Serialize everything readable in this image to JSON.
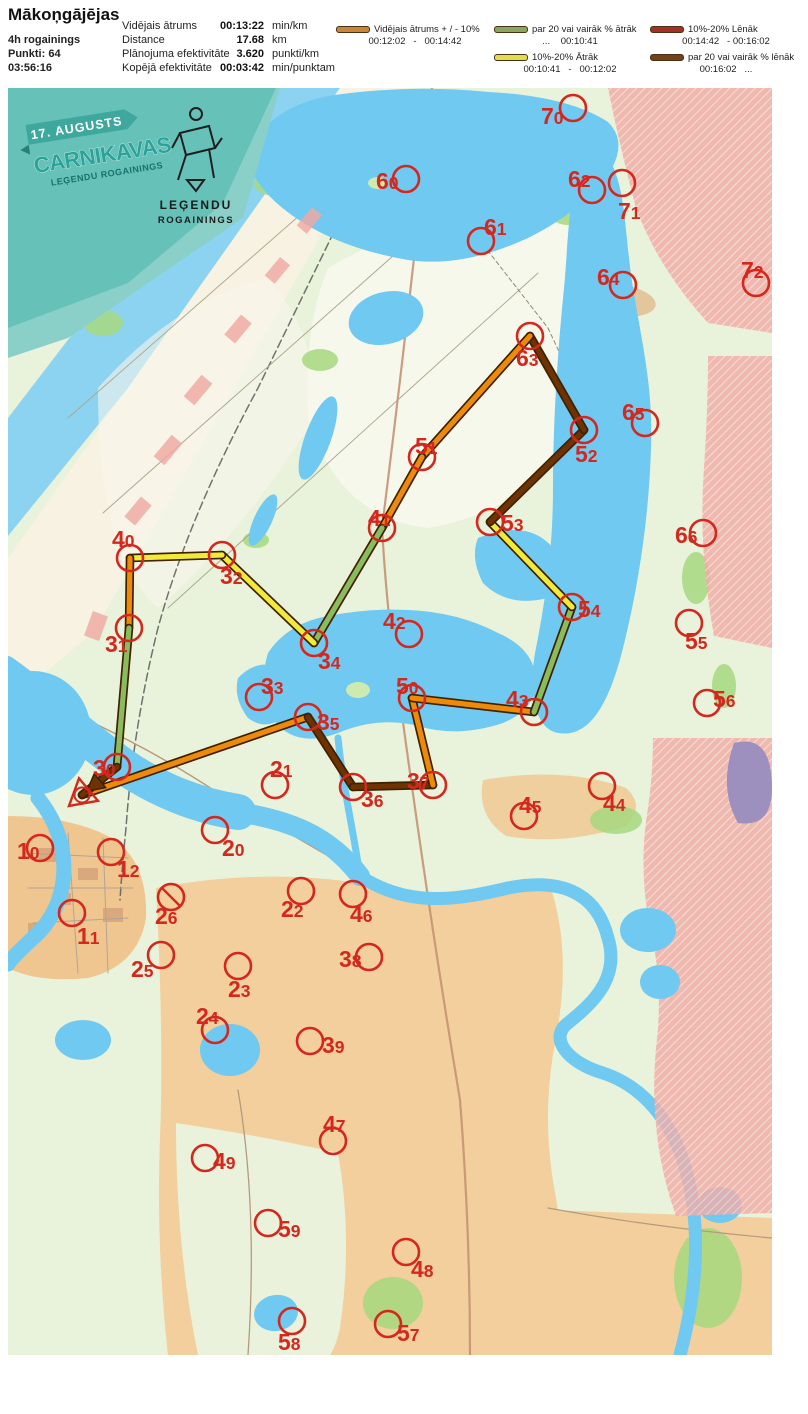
{
  "header": {
    "title": "Mākoņgājējas",
    "left": [
      "4h rogainings",
      "Punkti: 64",
      "03:56:16"
    ],
    "stats": [
      {
        "label": "Vidējais ātrums",
        "value": "00:13:22",
        "unit": "min/km"
      },
      {
        "label": "Distance",
        "value": "17.68",
        "unit": "km"
      },
      {
        "label": "Plānojuma efektivitāte",
        "value": "3.620",
        "unit": "punkti/km"
      },
      {
        "label": "Kopējā efektivitāte",
        "value": "00:03:42",
        "unit": "min/punktam"
      }
    ]
  },
  "legend": {
    "items": [
      {
        "color": "#C9863B",
        "label": "Vidējais ātrums + / - 10%",
        "range": "00:12:02   -   00:14:42"
      },
      {
        "color": "#8AA55F",
        "label": "par 20 vai vairāk % ātrāk",
        "range": "...    00:10:41"
      },
      {
        "color": "#E3DC4D",
        "label": "10%-20% Ātrāk",
        "range": "00:10:41   -   00:12:02"
      },
      {
        "color": "#A63028",
        "label": "10%-20% Lēnāk",
        "range": "00:14:42   - 00:16:02"
      },
      {
        "color": "#74421A",
        "label": "par 20 vai vairāk % lēnāk",
        "range": "00:16:02   ..."
      }
    ]
  },
  "banner": {
    "date": "17. AUGUSTS",
    "title": "CARNIKAVAS",
    "subtitle": "LEĢENDU ROGAININGS",
    "logo_line1": "LEĢENDU",
    "logo_line2": "ROGAININGS"
  },
  "map": {
    "marker_color": "#D4281F",
    "casing_color": "#3F2000",
    "colors": {
      "avg": "#EE8A0A",
      "fast20": "#8ABB5C",
      "fast10": "#F2EA3A",
      "slow10": "#A7312A",
      "slow20": "#6E3300"
    },
    "start": {
      "x": 74,
      "y": 707
    },
    "controls": [
      {
        "id": "10",
        "x": 32,
        "y": 760,
        "lx": 9,
        "ly": 771
      },
      {
        "id": "11",
        "x": 64,
        "y": 825,
        "lx": 69,
        "ly": 856
      },
      {
        "id": "12",
        "x": 103,
        "y": 764,
        "lx": 109,
        "ly": 789
      },
      {
        "id": "20",
        "x": 207,
        "y": 742,
        "lx": 214,
        "ly": 768
      },
      {
        "id": "21",
        "x": 267,
        "y": 697,
        "lx": 262,
        "ly": 689
      },
      {
        "id": "22",
        "x": 293,
        "y": 803,
        "lx": 273,
        "ly": 829
      },
      {
        "id": "23",
        "x": 230,
        "y": 878,
        "lx": 220,
        "ly": 909
      },
      {
        "id": "24",
        "x": 207,
        "y": 942,
        "lx": 188,
        "ly": 936
      },
      {
        "id": "25",
        "x": 153,
        "y": 867,
        "lx": 123,
        "ly": 889
      },
      {
        "id": "26",
        "x": 163,
        "y": 809,
        "lx": 147,
        "ly": 836,
        "slash": true
      },
      {
        "id": "30",
        "x": 109,
        "y": 679,
        "lx": 85,
        "ly": 688
      },
      {
        "id": "31",
        "x": 121,
        "y": 540,
        "lx": 97,
        "ly": 564
      },
      {
        "id": "32",
        "x": 214,
        "y": 467,
        "lx": 212,
        "ly": 496
      },
      {
        "id": "33",
        "x": 251,
        "y": 609,
        "lx": 253,
        "ly": 606
      },
      {
        "id": "34",
        "x": 306,
        "y": 555,
        "lx": 310,
        "ly": 581
      },
      {
        "id": "35",
        "x": 300,
        "y": 629,
        "lx": 309,
        "ly": 642
      },
      {
        "id": "36",
        "x": 345,
        "y": 699,
        "lx": 353,
        "ly": 719
      },
      {
        "id": "37",
        "x": 425,
        "y": 697,
        "lx": 399,
        "ly": 701
      },
      {
        "id": "38",
        "x": 361,
        "y": 869,
        "lx": 331,
        "ly": 879
      },
      {
        "id": "39",
        "x": 302,
        "y": 953,
        "lx": 314,
        "ly": 965
      },
      {
        "id": "40",
        "x": 122,
        "y": 470,
        "lx": 104,
        "ly": 459
      },
      {
        "id": "41",
        "x": 374,
        "y": 440,
        "lx": 360,
        "ly": 438
      },
      {
        "id": "42",
        "x": 401,
        "y": 546,
        "lx": 375,
        "ly": 541
      },
      {
        "id": "43",
        "x": 526,
        "y": 624,
        "lx": 498,
        "ly": 619
      },
      {
        "id": "44",
        "x": 594,
        "y": 698,
        "lx": 595,
        "ly": 723
      },
      {
        "id": "45",
        "x": 516,
        "y": 728,
        "lx": 511,
        "ly": 725
      },
      {
        "id": "46",
        "x": 345,
        "y": 806,
        "lx": 342,
        "ly": 834
      },
      {
        "id": "47",
        "x": 325,
        "y": 1053,
        "lx": 315,
        "ly": 1044
      },
      {
        "id": "48",
        "x": 398,
        "y": 1164,
        "lx": 403,
        "ly": 1189
      },
      {
        "id": "49",
        "x": 197,
        "y": 1070,
        "lx": 205,
        "ly": 1081
      },
      {
        "id": "50",
        "x": 404,
        "y": 610,
        "lx": 388,
        "ly": 606
      },
      {
        "id": "51",
        "x": 414,
        "y": 369,
        "lx": 407,
        "ly": 366
      },
      {
        "id": "52",
        "x": 576,
        "y": 342,
        "lx": 567,
        "ly": 374
      },
      {
        "id": "53",
        "x": 482,
        "y": 434,
        "lx": 493,
        "ly": 443
      },
      {
        "id": "54",
        "x": 564,
        "y": 519,
        "lx": 570,
        "ly": 529
      },
      {
        "id": "55",
        "x": 681,
        "y": 535,
        "lx": 677,
        "ly": 561
      },
      {
        "id": "56",
        "x": 699,
        "y": 615,
        "lx": 705,
        "ly": 619
      },
      {
        "id": "57",
        "x": 380,
        "y": 1236,
        "lx": 389,
        "ly": 1253
      },
      {
        "id": "58",
        "x": 284,
        "y": 1233,
        "lx": 270,
        "ly": 1262
      },
      {
        "id": "59",
        "x": 260,
        "y": 1135,
        "lx": 270,
        "ly": 1149
      },
      {
        "id": "60",
        "x": 398,
        "y": 91,
        "lx": 368,
        "ly": 101
      },
      {
        "id": "61",
        "x": 473,
        "y": 153,
        "lx": 476,
        "ly": 147
      },
      {
        "id": "62",
        "x": 584,
        "y": 102,
        "lx": 560,
        "ly": 99
      },
      {
        "id": "63",
        "x": 522,
        "y": 248,
        "lx": 508,
        "ly": 278
      },
      {
        "id": "64",
        "x": 615,
        "y": 197,
        "lx": 589,
        "ly": 197
      },
      {
        "id": "65",
        "x": 637,
        "y": 335,
        "lx": 614,
        "ly": 332
      },
      {
        "id": "66",
        "x": 695,
        "y": 445,
        "lx": 667,
        "ly": 455
      },
      {
        "id": "70",
        "x": 565,
        "y": 20,
        "lx": 533,
        "ly": 36
      },
      {
        "id": "71",
        "x": 614,
        "y": 95,
        "lx": 610,
        "ly": 131
      },
      {
        "id": "72",
        "x": 748,
        "y": 195,
        "lx": 733,
        "ly": 190
      }
    ],
    "route": [
      {
        "from": "S",
        "to": "35",
        "speed": "avg"
      },
      {
        "from": "35",
        "to": "36",
        "speed": "slow20"
      },
      {
        "from": "36",
        "to": "37",
        "speed": "slow20"
      },
      {
        "from": "37",
        "to": "50",
        "speed": "avg"
      },
      {
        "from": "50",
        "to": "43",
        "speed": "avg"
      },
      {
        "from": "43",
        "to": "54",
        "speed": "fast20"
      },
      {
        "from": "54",
        "to": "53",
        "speed": "fast10"
      },
      {
        "from": "53",
        "to": "52",
        "speed": "slow20"
      },
      {
        "from": "52",
        "to": "63",
        "speed": "slow20"
      },
      {
        "from": "63",
        "to": "51",
        "speed": "avg"
      },
      {
        "from": "51",
        "to": "41",
        "speed": "avg"
      },
      {
        "from": "41",
        "to": "34",
        "speed": "fast20"
      },
      {
        "from": "34",
        "to": "32",
        "speed": "fast10"
      },
      {
        "from": "32",
        "to": "40",
        "speed": "fast10"
      },
      {
        "from": "40",
        "to": "31",
        "speed": "avg"
      },
      {
        "from": "31",
        "to": "30",
        "speed": "fast20"
      },
      {
        "from": "30",
        "to": "S",
        "speed": "slow20",
        "arrow": true
      }
    ]
  }
}
